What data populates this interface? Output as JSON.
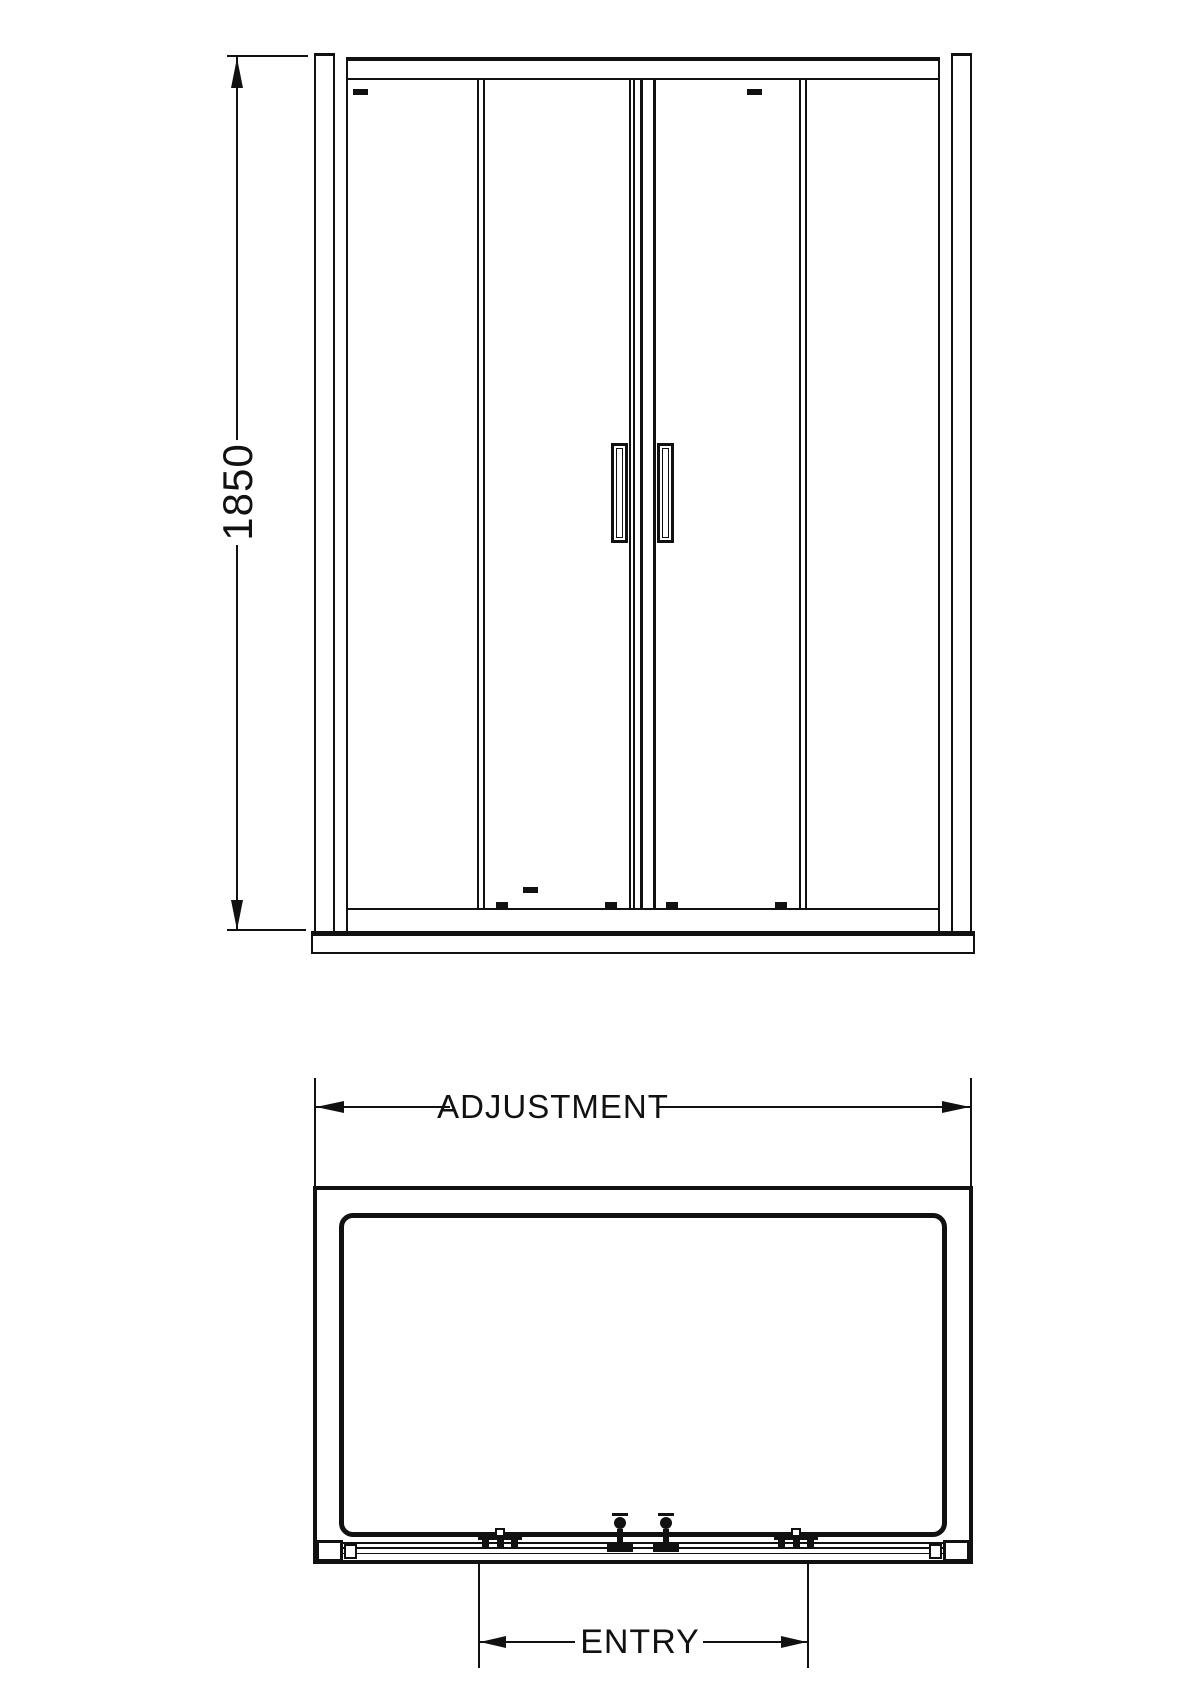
{
  "front_view": {
    "height_dimension_label": "1850"
  },
  "plan_view": {
    "width_dimension_label": "ADJUSTMENT",
    "entry_dimension_label": "ENTRY"
  },
  "colors": {
    "line": "#111111",
    "background": "#ffffff"
  }
}
